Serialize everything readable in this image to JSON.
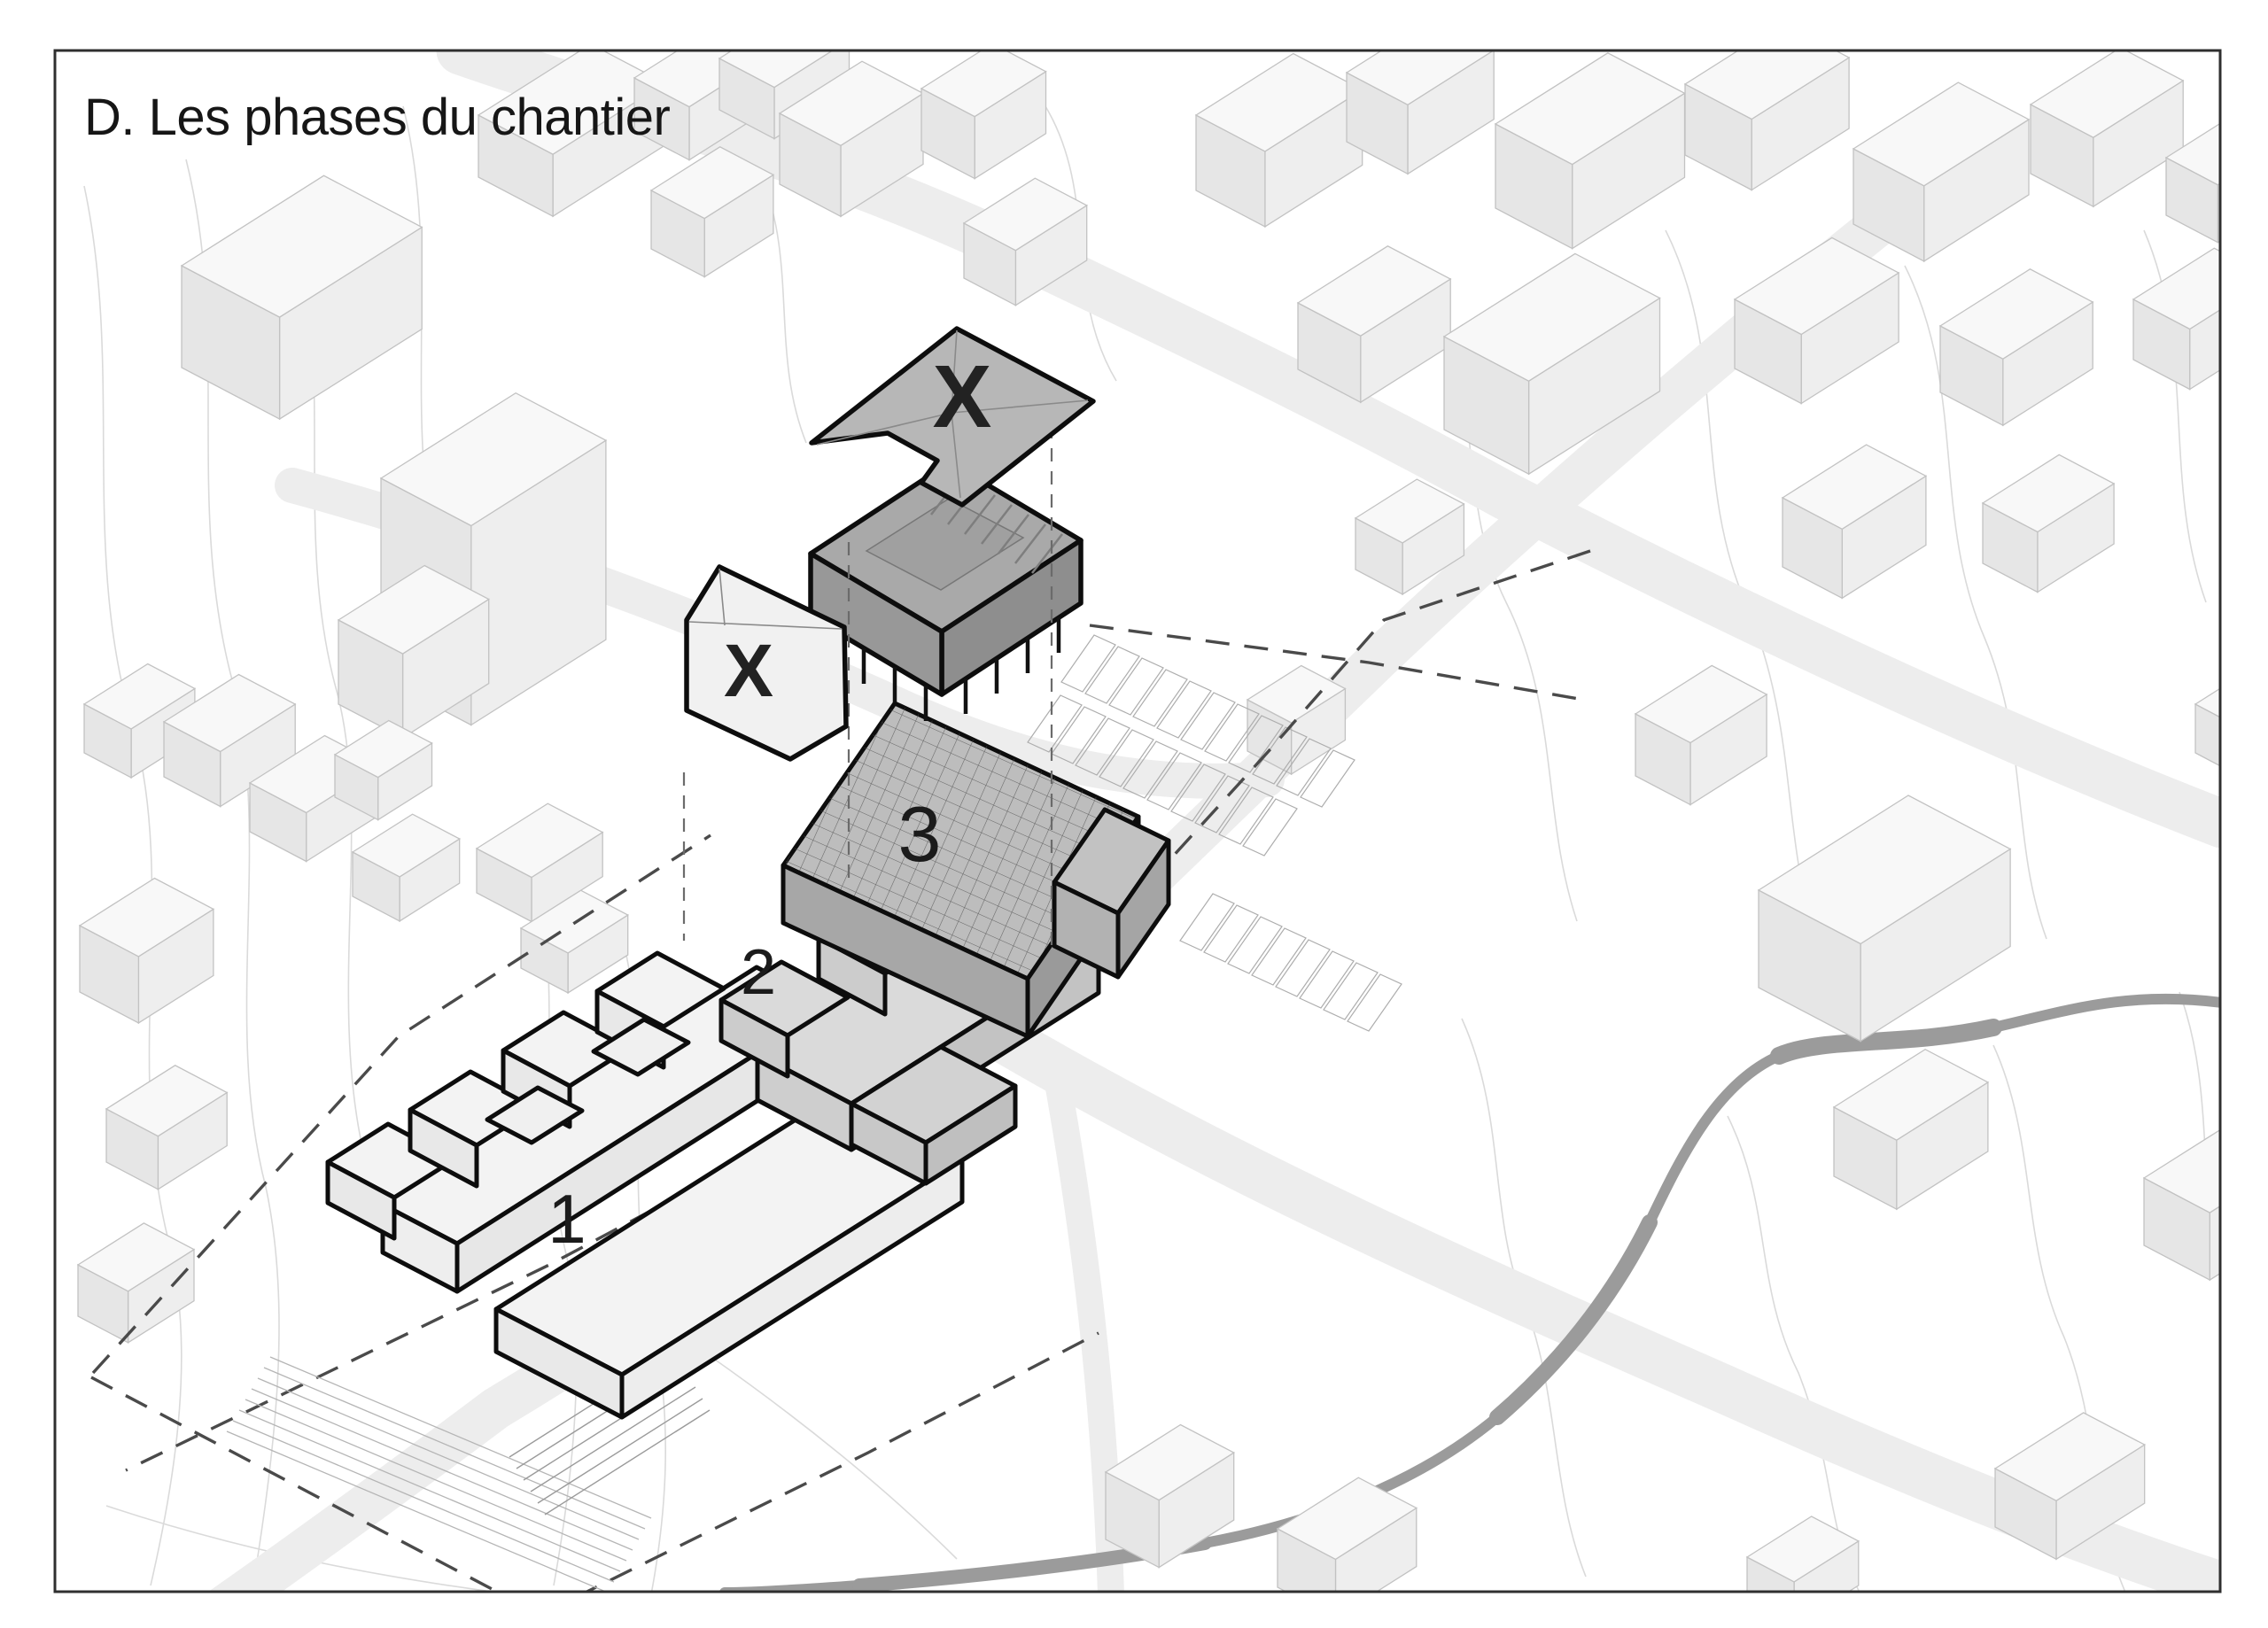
{
  "title": "D. Les phases du chantier",
  "phases": [
    {
      "label": "1"
    },
    {
      "label": "2"
    },
    {
      "label": "3"
    }
  ],
  "demolition_marks": [
    {
      "label": "X"
    },
    {
      "label": "X"
    }
  ],
  "colors": {
    "phase1": "#f3f3f3",
    "phase2": "#dadada",
    "phase3": "#bdbdbd",
    "existing_building": "#a9a9a9",
    "demolition_roof": "#b7b7b7",
    "outline": "#0d0d0d",
    "context_fill": "#f8f8f8",
    "context_stroke": "#c2c2c2",
    "road": "#ededed",
    "stream": "#9b9b9b",
    "boundary_dash": "#4a4a4a",
    "contour": "#dadada"
  }
}
